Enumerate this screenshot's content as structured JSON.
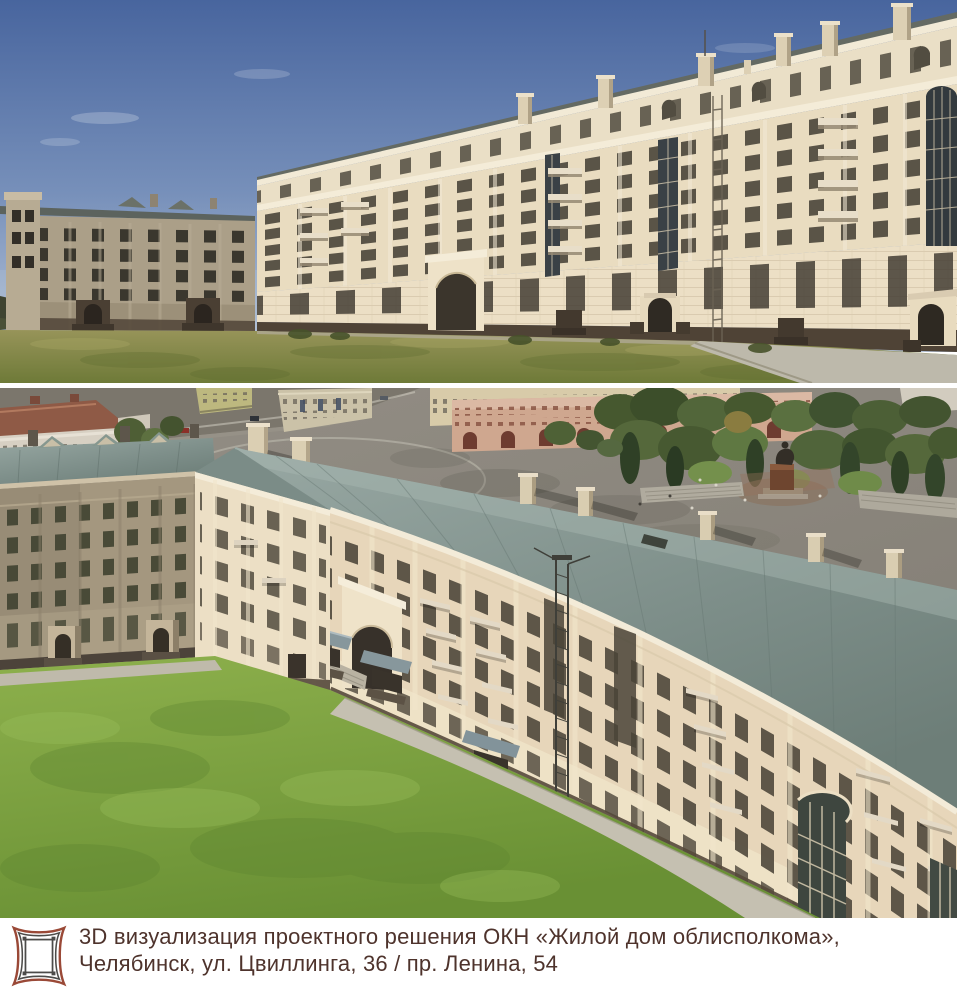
{
  "page": {
    "width": 957,
    "height": 995,
    "background": "#ffffff"
  },
  "renders": {
    "top": {
      "sky_top_color": "#48659e",
      "sky_horizon_color": "#b6c4d8",
      "facade_lit_color": "#e9dcc0",
      "facade_shadow_color": "#ab9f88",
      "lawn_color": "#8a8a4f",
      "walkway_color": "#bdb9ab",
      "plinth_color": "#4f4336"
    },
    "bottom": {
      "roof_color": "#7d8e89",
      "facade_color": "#e7d6ba",
      "courtyard_lawn_color": "#7da63f",
      "square_asphalt_color": "#8d887e",
      "trees_color": "#46582f",
      "monument_pedestal_color": "#6e452f"
    }
  },
  "caption": {
    "line1": "3D визуализация проектного решения ОКН «Жилой дом облисполкома»,",
    "line2": "Челябинск, ул. Цвиллинга, 36 / пр. Ленина, 54",
    "text_color": "#4e332c"
  },
  "logo": {
    "icon": "ornamental-frame-logo",
    "primary_color": "#9a4937",
    "secondary_color": "#4c4b49"
  }
}
